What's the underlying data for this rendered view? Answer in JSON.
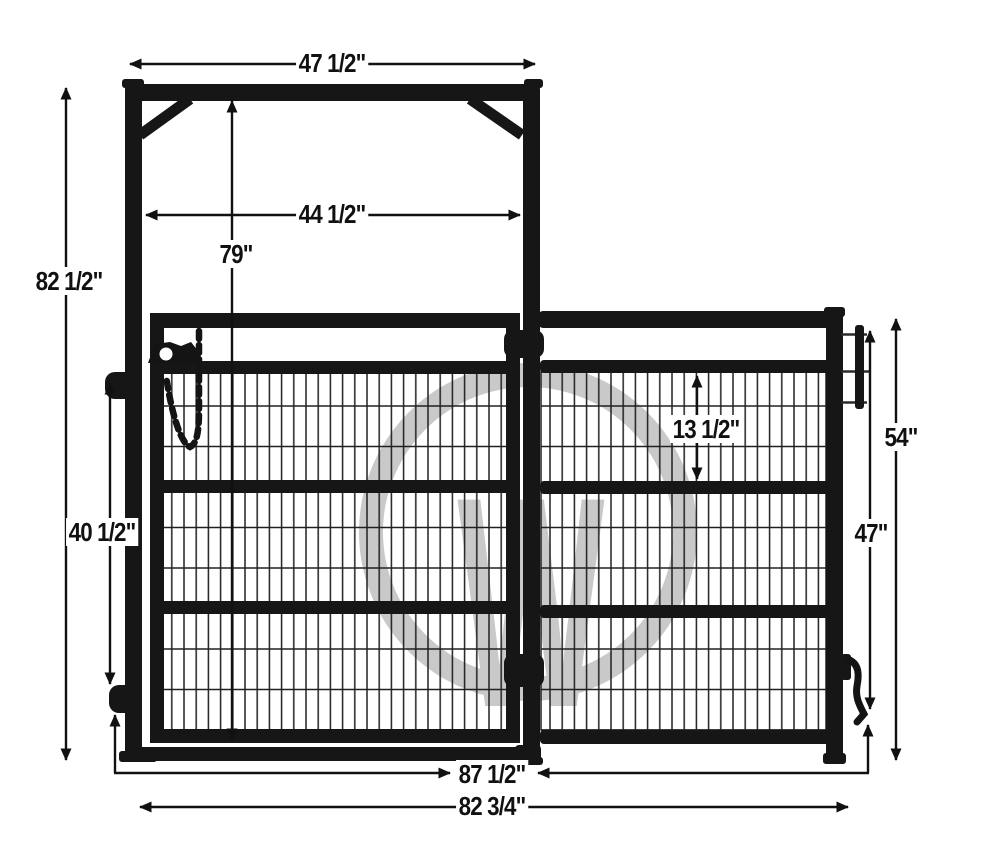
{
  "diagram": {
    "title": "gate frame with walk gate and side panel dimension diagram",
    "watermark": {
      "letter": "W",
      "color": "#c9c9c9"
    },
    "colors": {
      "steel": "#161616",
      "mesh_wire": "#202020",
      "dimension_line": "#111111",
      "background": "#ffffff"
    },
    "dimensions": {
      "frame_width": "47 1/2\"",
      "frame_height": "82 1/2\"",
      "opening_width": "44 1/2\"",
      "opening_height": "79\"",
      "latch_spacing": "40 1/2\"",
      "panel_top_section": "13 1/2\"",
      "panel_height": "54\"",
      "panel_frame_height": "47\"",
      "overall_width_a": "87 1/2\"",
      "overall_width_b": "82 3/4\""
    }
  }
}
